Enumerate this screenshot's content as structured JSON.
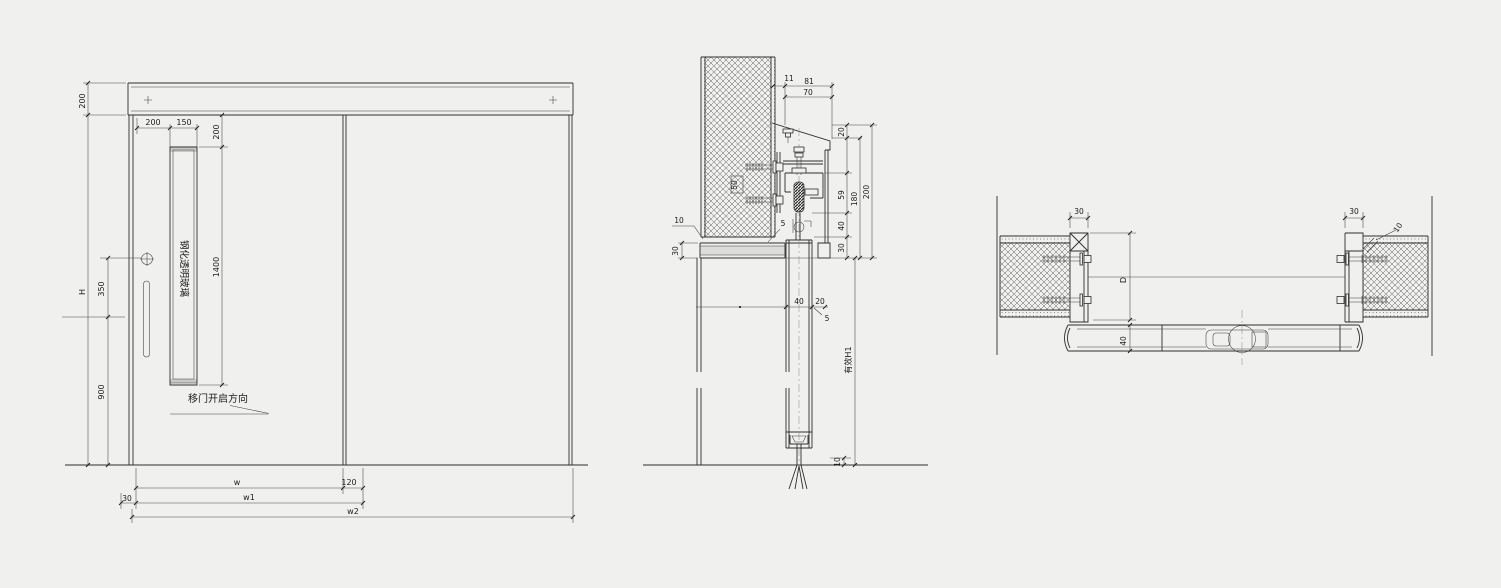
{
  "drawing": {
    "type": "sliding-door-construction-detail",
    "elevation": {
      "glass_label": "钢化透明玻璃",
      "direction_label": "移门开启方向",
      "dims": {
        "header_height": "200",
        "door_height": "H",
        "lock_offset": "350",
        "handle_height": "900",
        "glass_left_offset": "200",
        "glass_width": "150",
        "glass_top_offset": "200",
        "glass_height": "1400",
        "edge_offset": "30",
        "leaf_width": "w",
        "overlap": "120",
        "width1": "w1",
        "width2": "w2"
      }
    },
    "section": {
      "effective_height_label": "有效H1",
      "dims": {
        "offset11": "11",
        "total81": "81",
        "track_width": "70",
        "cover_top": "20",
        "track_zone": "59",
        "inner_height": "180",
        "total_height": "200",
        "hanger": "40",
        "lintel": "30",
        "plaster_left": "10",
        "lintel_height": "30",
        "embed_plate": "50",
        "gap_top": "5",
        "leaf_thickness": "40",
        "side_gap": "20",
        "seal": "5",
        "floor_clearance": "10"
      }
    },
    "plan": {
      "dims": {
        "left_jamb": "30",
        "right_jamb": "30",
        "plaster": "10",
        "pocket_depth": "D",
        "leaf_thickness": "40"
      }
    },
    "line_color": "#2e2e2e",
    "background_color": "#f0f0ee"
  }
}
